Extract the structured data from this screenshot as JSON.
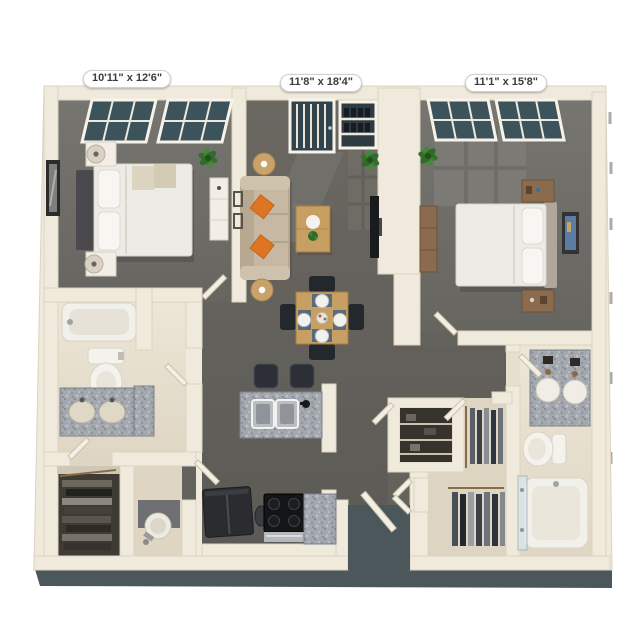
{
  "meta": {
    "description": "3D top-down rendering of a two-bedroom, two-bathroom apartment floor plan on a white background",
    "view": "3d-top-view-floor-plan"
  },
  "dimension_labels": [
    {
      "room": "bedroom-1",
      "text": "10'11\" x 12'6\""
    },
    {
      "room": "living-dining-room",
      "text": "11'8\" x 18'4\""
    },
    {
      "room": "bedroom-2",
      "text": "11'1\" x 15'8\""
    }
  ],
  "rooms": [
    {
      "name": "bedroom-1",
      "furniture": [
        "queen bed with white bedding and dark headboard",
        "two white nightstands with lamps",
        "white dresser",
        "framed wall art",
        "potted plant",
        "two windows with blinds"
      ]
    },
    {
      "name": "living-dining-room",
      "furniture": [
        "beige sofa with two orange accent pillows",
        "two shaded floor lamps",
        "wood coffee table with plant",
        "wall-mounted tv",
        "dining table with four chairs and place settings",
        "balcony door",
        "window shelf",
        "potted plants"
      ]
    },
    {
      "name": "bedroom-2",
      "furniture": [
        "queen bed with white bedding",
        "two wood nightstands",
        "wood dresser",
        "framed wall art",
        "potted plant",
        "two windows with blinds",
        "sunlight patch on carpet"
      ]
    },
    {
      "name": "kitchen",
      "furniture": [
        "granite breakfast bar with double sink and faucet",
        "two bar stools",
        "refrigerator",
        "range with four burners",
        "granite counter",
        "trash can"
      ]
    },
    {
      "name": "bathroom-1",
      "furniture": [
        "bathtub",
        "toilet",
        "granite vanity with two sinks"
      ]
    },
    {
      "name": "bathroom-2",
      "furniture": [
        "granite double vanity with two round sinks",
        "toilet",
        "bathtub with glass panel"
      ]
    },
    {
      "name": "walk-in-closet-1",
      "furniture": [
        "hanging clothes"
      ]
    },
    {
      "name": "utility-room",
      "furniture": [
        "water heater"
      ]
    },
    {
      "name": "pantry-closet",
      "furniture": [
        "shelving"
      ]
    },
    {
      "name": "walk-in-closet-2",
      "furniture": [
        "hanging clothes"
      ]
    },
    {
      "name": "entry",
      "furniture": [
        "open front door"
      ]
    }
  ],
  "colors": {
    "background": "#ffffff",
    "walls": "#F0EADD",
    "bedroom_carpet": "#6F6D68",
    "living_floor": "#636059",
    "bathroom_floor": "#E7DFCD",
    "closet_dark": "#3E3A34",
    "window_glass": "#3D535C",
    "base_shadow_band": "#4C575B",
    "sofa": "#C6B8A2",
    "accent_pillow_orange": "#DD7522",
    "light_wood": "#C89F63",
    "dark_wood": "#8B6B4E",
    "granite": "#A3A7AE",
    "appliance_dark": "#2B2C30",
    "plant_green": "#3E7A34",
    "bedding_white": "#EDEBE5"
  }
}
